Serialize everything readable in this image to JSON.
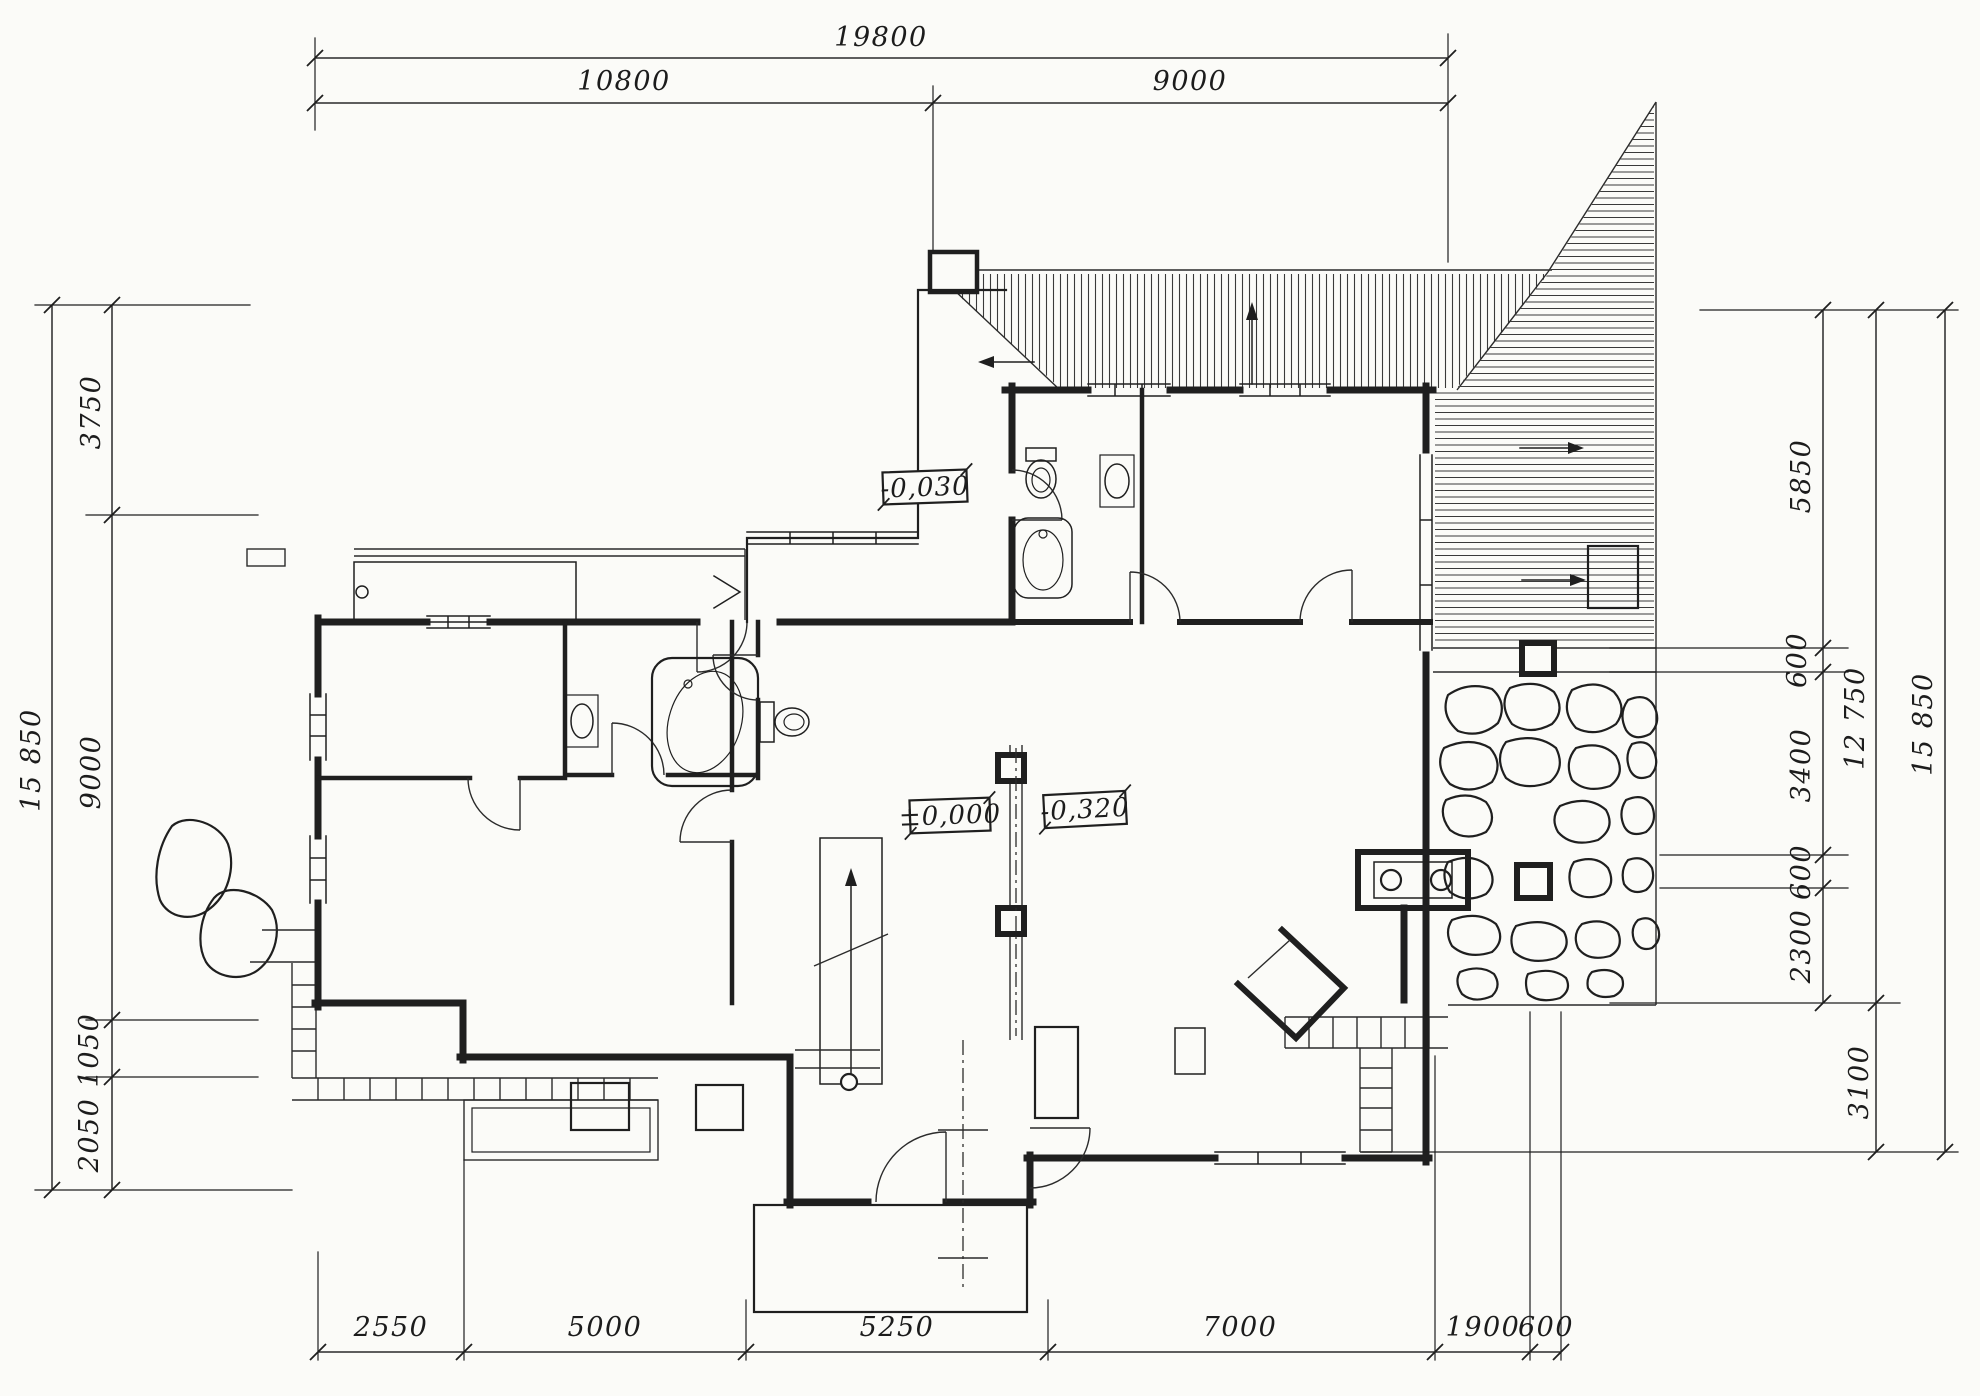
{
  "sheet": {
    "kind": "hand-drawn architectural floor plan sketch",
    "paper_color": "#fbfbf8",
    "ink_color": "#1f1f1f"
  },
  "dims": {
    "top_overall": "19800",
    "top_segs": [
      "10800",
      "9000"
    ],
    "left_overall": "15 850",
    "left_segs": [
      "3750",
      "9000",
      "1050",
      "2050"
    ],
    "right_segs": [
      "5850",
      "600",
      "3400",
      "600",
      "2300",
      "3100"
    ],
    "right_subtotal": "12 750",
    "right_overall": "15 850",
    "bottom_segs": [
      "2550",
      "5000",
      "5250",
      "7000",
      "1900",
      "600"
    ]
  },
  "levels": {
    "hall": "-0,030",
    "entry": "±0,000",
    "terrace": "-0,320"
  }
}
